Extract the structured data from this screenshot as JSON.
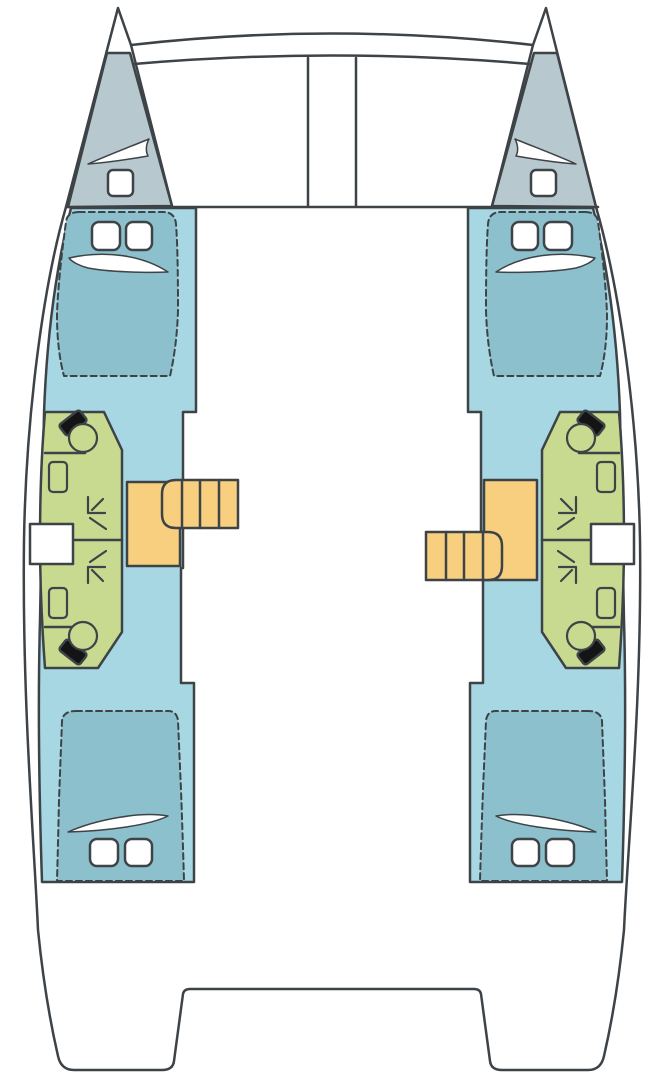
{
  "diagram": {
    "kind": "catamaran-deck-plan",
    "hulls": [
      {
        "id": "port",
        "areas": [
          "forepeak-berth",
          "forward-double-cabin",
          "forward-bathroom",
          "aft-bathroom",
          "aft-double-cabin"
        ],
        "features": [
          "bow-window",
          "cabin-pillows",
          "toilet",
          "sink",
          "shower",
          "side-gate",
          "companionway-stairs",
          "stair-landing"
        ]
      },
      {
        "id": "starboard",
        "areas": [
          "forepeak-berth",
          "forward-double-cabin",
          "forward-bathroom",
          "aft-bathroom",
          "aft-double-cabin"
        ],
        "features": [
          "bow-window",
          "cabin-pillows",
          "toilet",
          "sink",
          "shower",
          "side-gate",
          "companionway-stairs",
          "stair-landing"
        ]
      }
    ],
    "center_structures": [
      "forward-crossbeam",
      "trampoline",
      "mast-base-beam",
      "bridgedeck",
      "stern-platform-cutout"
    ]
  },
  "colors": {
    "outline": "#3d4347",
    "hull_white": "#ffffff",
    "interior": "#a6d7e3",
    "berth": "#8dc0cd",
    "forepeak": "#b7c9cf",
    "bathroom": "#c7da90",
    "stairs": "#f7cf7e",
    "fixture": "#141414",
    "white": "#ffffff"
  }
}
